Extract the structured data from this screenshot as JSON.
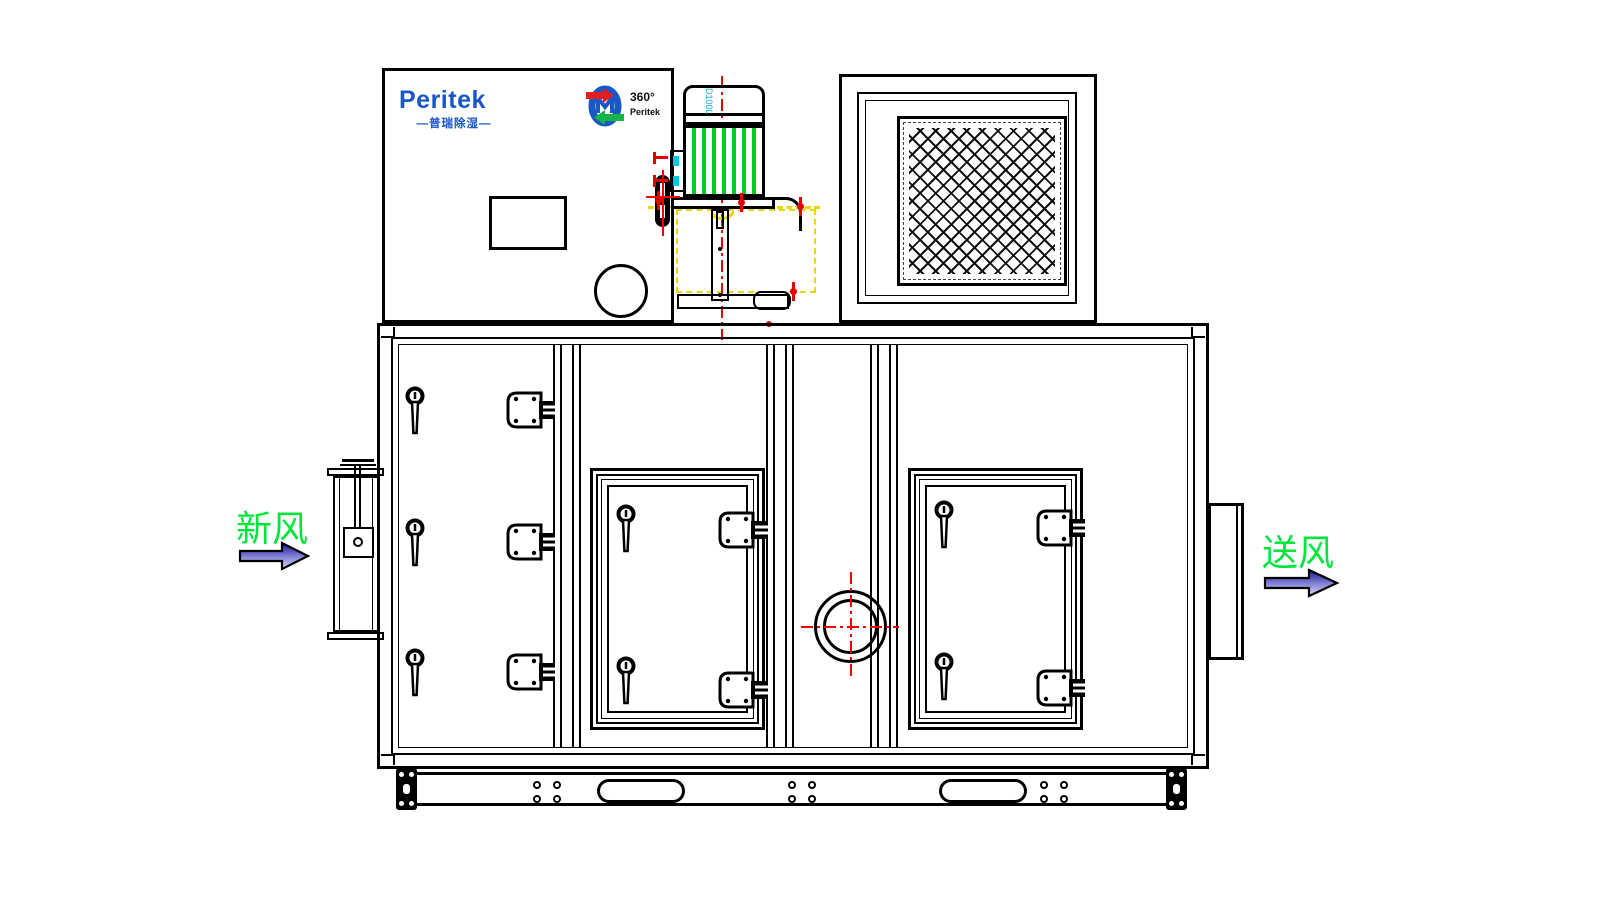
{
  "drawing": {
    "brand_logo": {
      "name": "Peritek",
      "subtitle": "—普瑞除湿—"
    },
    "rotor_logo": {
      "degrees": "360°",
      "brand": "Peritek"
    },
    "motor": {
      "model_label": "D100L"
    },
    "flow_labels": {
      "inlet": "新风",
      "outlet": "送风"
    },
    "colors": {
      "line": "#000000",
      "brand_blue": "#1857c8",
      "flow_green": "#00e63c",
      "fin_green": "#00cc22",
      "centerline_red": "#f20000",
      "hidden_yellow": "#e8d800",
      "accent_cyan": "#00c8e0",
      "arrow_dark": "#14149a",
      "arrow_light": "#d8d8f8"
    }
  }
}
